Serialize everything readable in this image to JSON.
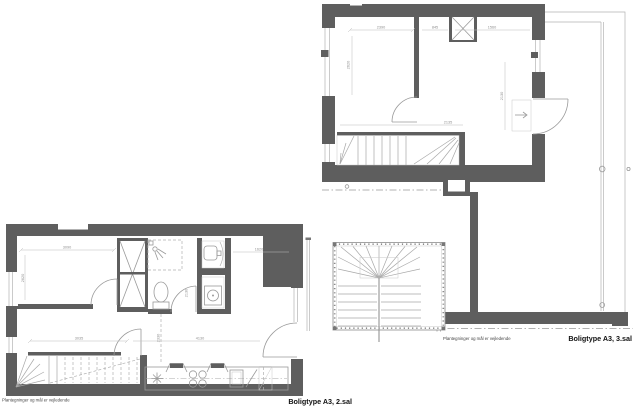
{
  "document": {
    "type": "architectural floor plan sheet",
    "background": "#ffffff"
  },
  "colors": {
    "wall_fill": "#5e5e5e",
    "thin_line": "#b3b3b3",
    "fixture_line": "#9a9a9a",
    "stair_line": "#a8a8a8",
    "dim_text": "#8f8f8f",
    "caption_text": "#111111",
    "disclaimer_text": "#444444"
  },
  "plan_3sal": {
    "caption": "Boligtype A3, 3.sal",
    "disclaimer": "Plantegninger og mål er vejledende",
    "dims": [
      "2390",
      "845",
      "1560",
      "2620",
      "2130",
      "2135"
    ]
  },
  "plan_2sal": {
    "caption": "Boligtype A3, 2.sal",
    "disclaimer": "Plantegninger og mål er vejledende",
    "dims": [
      "3090",
      "2620",
      "1620",
      "2130",
      "3035",
      "4130",
      "2330"
    ]
  }
}
